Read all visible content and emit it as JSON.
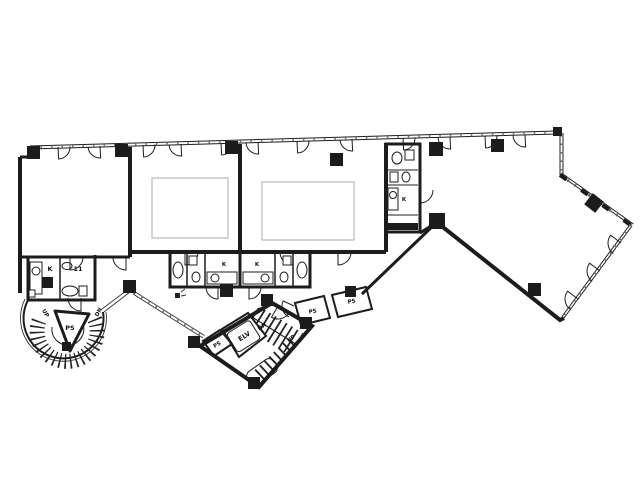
{
  "drawing": {
    "background": "#ffffff",
    "ink": "#1c1c1c",
    "rooms": {
      "elevator": {
        "label": "ELV"
      },
      "stair_core": {
        "up": "UP",
        "down": "DN"
      },
      "spiral_stair": {
        "up": "UP",
        "down": "DN",
        "shaft": "PS"
      },
      "pipe_shafts": {
        "core_left": "PS",
        "hall_small": "PS",
        "hall_large": "PS"
      },
      "kitchenettes": {
        "left_block": "K",
        "wc_band_left": "K",
        "wc_band_right": "K",
        "right_unit": "K"
      },
      "left_block_toilet": {
        "label": "11"
      }
    }
  }
}
